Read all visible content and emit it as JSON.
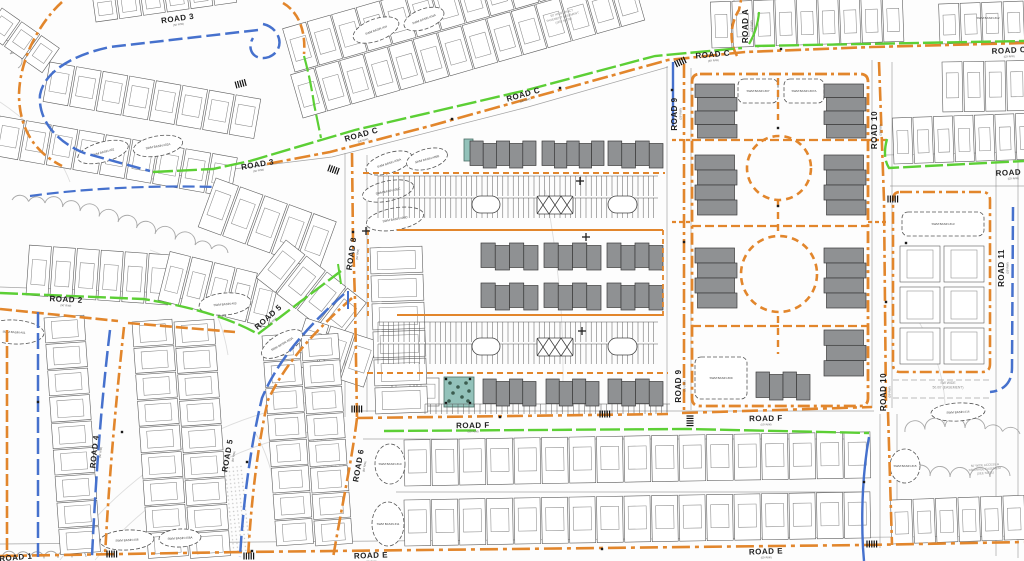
{
  "colors": {
    "bg": "#fdfdfd",
    "line": "#5e5e5e",
    "line_light": "#9a9a9a",
    "contour": "#c2c2c2",
    "orange": "#e2862c",
    "blue": "#4671cd",
    "green": "#5ccf35",
    "building": "#8f9193",
    "building_stroke": "#3a3a3a",
    "park": "#93c2ba",
    "tree": "#2c4a3c",
    "label": "#1f1f1f",
    "swm_label": "#444444",
    "note": "#8a8a8a",
    "tick": "#111111"
  },
  "canvas": {
    "w": 1024,
    "h": 561
  },
  "rw_sub": "(50' R/W)",
  "road_labels": [
    {
      "t": "ROAD 3",
      "x": 178,
      "y": 21,
      "r": -8
    },
    {
      "t": "ROAD 3",
      "x": 258,
      "y": 167,
      "r": -10
    },
    {
      "t": "ROAD C",
      "x": 362,
      "y": 137,
      "r": -16
    },
    {
      "t": "ROAD C",
      "x": 524,
      "y": 97,
      "r": -16
    },
    {
      "t": "ROAD C",
      "x": 713,
      "y": 57,
      "r": -5
    },
    {
      "t": "ROAD C",
      "x": 1009,
      "y": 53,
      "r": -3
    },
    {
      "t": "ROAD A",
      "x": 748,
      "y": 26,
      "r": -90
    },
    {
      "t": "ROAD 9",
      "x": 677,
      "y": 114,
      "r": -90
    },
    {
      "t": "ROAD 9",
      "x": 681,
      "y": 386,
      "r": -90
    },
    {
      "t": "ROAD 10",
      "x": 877,
      "y": 130,
      "r": -90
    },
    {
      "t": "ROAD 10",
      "x": 886,
      "y": 392,
      "r": -90
    },
    {
      "t": "ROAD 11",
      "x": 1004,
      "y": 268,
      "r": -90
    },
    {
      "t": "ROAD 8",
      "x": 354,
      "y": 254,
      "r": -82
    },
    {
      "t": "ROAD 6",
      "x": 361,
      "y": 466,
      "r": -80
    },
    {
      "t": "ROAD 4",
      "x": 97,
      "y": 452,
      "r": -84
    },
    {
      "t": "ROAD 5",
      "x": 230,
      "y": 456,
      "r": -80
    },
    {
      "t": "ROAD 5",
      "x": 270,
      "y": 319,
      "r": -42
    },
    {
      "t": "ROAD 2",
      "x": 66,
      "y": 302,
      "r": 3
    },
    {
      "t": "ROAD D",
      "x": 1013,
      "y": 175,
      "r": -3
    },
    {
      "t": "ROAD E",
      "x": 371,
      "y": 558,
      "r": -2
    },
    {
      "t": "ROAD E",
      "x": 766,
      "y": 554,
      "r": -2
    },
    {
      "t": "ROAD F",
      "x": 473,
      "y": 428,
      "r": -1
    },
    {
      "t": "ROAD F",
      "x": 766,
      "y": 421,
      "r": -1
    },
    {
      "t": "ROAD 1",
      "x": 16,
      "y": 560,
      "r": -5
    }
  ],
  "basins": [
    [
      103,
      152,
      26,
      10,
      -15,
      "e",
      "SWM BASIN #02"
    ],
    [
      158,
      146,
      25,
      10,
      -10,
      "e",
      "SWM BASIN #02A"
    ],
    [
      376,
      30,
      24,
      11,
      -20,
      "e",
      "SWM BASIN #04"
    ],
    [
      424,
      19,
      21,
      10,
      -20,
      "e",
      "SWM BASIN #04A"
    ],
    [
      389,
      163,
      24,
      10,
      -18,
      "e",
      "SWM BASIN #05A"
    ],
    [
      427,
      159,
      21,
      10,
      -15,
      "e",
      "SWM BASIN #05B"
    ],
    [
      388,
      191,
      26,
      10,
      -12,
      "e",
      "SWM BASIN #05C"
    ],
    [
      395,
      219,
      29,
      11,
      -10,
      "e",
      "SWM BASIN #05D"
    ],
    [
      14,
      332,
      30,
      12,
      3,
      "e",
      "SWM BASIN #01"
    ],
    [
      225,
      304,
      26,
      11,
      -5,
      "e",
      "SWM BASIN #03"
    ],
    [
      282,
      344,
      23,
      10,
      -30,
      "e",
      "SWM BASIN #03A"
    ],
    [
      127,
      540,
      27,
      10,
      -3,
      "e",
      "SWM BASIN #06"
    ],
    [
      180,
      538,
      21,
      9,
      -3,
      "e",
      "SWM BASIN #06A"
    ],
    [
      390,
      464,
      15,
      20,
      0,
      "e",
      "SWM BASIN #10"
    ],
    [
      388,
      524,
      16,
      22,
      0,
      "e",
      "SWM BASIN #11"
    ],
    [
      758,
      91,
      20,
      12,
      0,
      "r",
      "SWM BASIN #07"
    ],
    [
      804,
      91,
      20,
      12,
      0,
      "r",
      "SWM BASIN #07A"
    ],
    [
      721,
      378,
      26,
      21,
      0,
      "r",
      "SWM BASIN #09"
    ],
    [
      943,
      224,
      41,
      12,
      0,
      "r",
      "SWM BASIN #13"
    ],
    [
      958,
      412,
      27,
      9,
      -3,
      "e",
      "SWM BASIN #14"
    ],
    [
      905,
      466,
      15,
      17,
      0,
      "e",
      "SWM BASIN #15"
    ],
    [
      988,
      18,
      0,
      0,
      0,
      "l",
      "SWM BASIN #12"
    ]
  ],
  "notes": [
    {
      "x": 562,
      "y": 14,
      "r": -15,
      "s": 3,
      "lines": [
        "50' WIDE TRACT",
        "PAVEMENT EASEMENT",
        "(SEE NOTE)"
      ]
    },
    {
      "x": 948,
      "y": 384,
      "r": 0,
      "s": 3.4,
      "lines": [
        "SW WIDE",
        "50.00' (EASEMENT)"
      ]
    },
    {
      "x": 985,
      "y": 466,
      "r": -4,
      "s": 3,
      "lines": [
        "50' WIDE ACCESS &",
        "DRAINAGE EASEMENT",
        "(SEE NOTE)"
      ]
    }
  ],
  "utilities": {
    "orange": [
      {
        "d": "M62,2 C40,22 20,58 19,94 C19,128 34,152 62,166",
        "dash": "12 4 3 4"
      },
      {
        "d": "M267,164 L330,152 L430,126 L527,99 L668,60 L745,52 L872,47 L1024,43",
        "dash": "16 4 4 4"
      },
      {
        "d": "M737,56 C729,42 730,24 739,10 L741,0",
        "dash": "10 4"
      },
      {
        "d": "M283,3 C299,12 306,32 304,54",
        "dash": "10 4"
      },
      {
        "d": "M352,153 L353,240 L355,300 L357,418",
        "dash": "14 4 3 4"
      },
      {
        "d": "M357,418 C352,460 341,510 333,558",
        "dash": "14 4 3 4"
      },
      {
        "d": "M357,418 L668,414",
        "dash": "16 5 4 5"
      },
      {
        "d": "M682,413 L872,407",
        "dash": "16 5 4 5"
      },
      {
        "d": "M684,64 L684,413",
        "dash": "14 4 3 4"
      },
      {
        "d": "M879,62 L884,200 L886,410",
        "dash": "14 4 3 4"
      },
      {
        "d": "M888,412 L892,545",
        "dash": "14 4 3 4"
      },
      {
        "d": "M0,556 L243,552 L512,549 L864,545 L1024,542",
        "dash": "18 5 4 5"
      },
      {
        "d": "M7,330 L7,556",
        "dash": "12 4"
      },
      {
        "d": "M0,309 L118,321 M128,323 L235,332",
        "dash": "12 4"
      },
      {
        "d": "M124,327 C115,410 109,480 105,556",
        "dash": "12 4 3 4"
      },
      {
        "d": "M352,298 C314,332 286,362 268,400 C257,448 251,505 248,557",
        "dash": "12 4 3 4"
      },
      {
        "d": "M700,74 L860,74 Q868,74 868,82 L868,398 Q868,406 860,406 L700,406 Q692,406 692,398 L692,82 Q692,74 700,74",
        "dash": "12 4 3 4",
        "w": 2.8
      },
      {
        "d": "M778,78 L778,120 M778,200 L778,231 M778,316 L778,354",
        "dash": "7 5",
        "w": 2.4
      },
      {
        "d": "M692,140 L868,140 M692,226 L868,226 M692,326 L868,326",
        "dash": "9 4",
        "w": 2.2
      },
      {
        "d": "M672,140 L692,140 M868,140 L886,140 M672,222 L692,222 M868,222 L886,222",
        "dash": "4 3",
        "w": 2.2
      },
      {
        "d": "M900,192 L982,192 Q990,192 990,200 L990,364 Q990,372 982,372 L900,372 Q893,372 893,364 L893,200 Q893,192 900,192",
        "dash": "12 4 3 4",
        "w": 2.6
      },
      {
        "d": "M363,173 L665,173 M367,373 L668,373",
        "dash": "6 4",
        "w": 2
      },
      {
        "d": "M397,230 L663,230 M397,315 L663,315",
        "w": 2
      },
      {
        "d": "M368,230 L368,318 M663,230 L663,318",
        "dash": "5 4",
        "w": 1.8
      }
    ],
    "blue": [
      {
        "d": "M263,24 C281,28 286,50 269,57 C254,62 246,49 253,38",
        "dash": "14 5"
      },
      {
        "d": "M258,30 L110,47 C72,55 44,72 40,95 C38,119 55,141 84,153 L150,171",
        "dash": "14 5"
      },
      {
        "d": "M30,196 C80,189 150,185 215,187",
        "dash": "12 5",
        "w": 2.2
      },
      {
        "d": "M673,62 L673,126",
        "w": 2.4
      },
      {
        "d": "M348,291 L348,309",
        "w": 2
      },
      {
        "d": "M38,312 L38,557",
        "dash": "16 5"
      },
      {
        "d": "M110,330 C101,405 96,475 92,556",
        "dash": "16 5"
      },
      {
        "d": "M344,294 C306,328 278,360 262,398 C250,448 243,505 240,557",
        "dash": "16 5"
      },
      {
        "d": "M869,437 C863,470 861,510 863,548 L864,561",
        "w": 2.4
      },
      {
        "d": "M1013,207 L1012,368 C1012,384 1002,391 990,392",
        "dash": "14 5"
      }
    ],
    "green": [
      {
        "d": "M153,172 L213,169 L250,161 L355,130 L527,90 L655,56 L742,48",
        "dash": "20 4"
      },
      {
        "d": "M755,46 L1024,41",
        "dash": "20 4"
      },
      {
        "d": "M749,44 C755,34 758,24 759,12",
        "w": 2.2
      },
      {
        "d": "M304,56 C309,74 312,90 314,104 L321,138",
        "dash": "16 4",
        "w": 2.2
      },
      {
        "d": "M0,293 L143,299 C200,308 235,321 258,334 L300,302 L341,271",
        "dash": "18 4"
      },
      {
        "d": "M338,264 L341,284",
        "w": 2
      },
      {
        "d": "M384,431 L687,429 L869,433",
        "dash": "20 4"
      },
      {
        "d": "M887,139 C884,150 884,160 889,168 L1024,161",
        "dash": "18 4"
      }
    ]
  },
  "edges": [
    {
      "d": "M152,179 L332,157 L528,107 L668,67"
    },
    {
      "d": "M345,153 L345,417 M367,155 L367,412"
    },
    {
      "d": "M667,66 L667,412 M691,68 L691,410"
    },
    {
      "d": "M872,60 L872,408 M892,62 L892,408 M880,414 L880,548 M897,414 L897,545"
    },
    {
      "d": "M996,160 L996,556 M1018,152 L1018,558"
    },
    {
      "d": "M357,411 L874,411 M363,439 L870,439"
    },
    {
      "d": "M734,0 L734,52 M758,0 L758,48"
    },
    {
      "d": "M890,186 L1024,186 M886,155 L1024,152"
    },
    {
      "d": "M0,544 L1024,536"
    },
    {
      "d": "M0,287 L145,292 C205,300 240,315 262,328"
    },
    {
      "d": "M396,492 L868,492"
    },
    {
      "d": "M893,380 L990,380 M893,398 L990,398",
      "dash": "6 3"
    }
  ],
  "contours": [
    "M60,560 C120,480 200,420 320,400",
    "M95,560 C155,490 235,440 335,428",
    "M150,250 C195,265 220,305 228,355",
    "M545,190 C558,255 566,330 562,412",
    "M905,300 C930,335 950,382 944,425",
    "M0,102 C30,122 58,150 70,182",
    "M255,432 C272,462 281,500 276,540"
  ],
  "scallops": [
    {
      "pts": [
        [
          12,
          200
        ],
        [
          45,
          203
        ],
        [
          80,
          211
        ],
        [
          118,
          222
        ],
        [
          155,
          234
        ],
        [
          195,
          245
        ],
        [
          228,
          253
        ]
      ],
      "r": 9
    },
    {
      "pts": [
        [
          905,
          432
        ],
        [
          945,
          427
        ],
        [
          985,
          429
        ],
        [
          1020,
          434
        ]
      ],
      "r": 10
    },
    {
      "pts": [
        [
          893,
          470
        ],
        [
          930,
          476
        ],
        [
          970,
          478
        ],
        [
          1010,
          476
        ]
      ],
      "r": 9
    },
    {
      "pts": [
        [
          2,
          558
        ],
        [
          30,
          559
        ],
        [
          58,
          558
        ],
        [
          86,
          557
        ]
      ],
      "r": 7
    },
    {
      "pts": [
        [
          0,
          42
        ],
        [
          10,
          54
        ],
        [
          18,
          68
        ]
      ],
      "r": 7
    }
  ],
  "stipples": [
    [
      300,
      390,
      40,
      90,
      -5
    ],
    [
      217,
      468,
      26,
      86,
      -6
    ]
  ],
  "lot_strips": [
    {
      "x": 50,
      "y": 62,
      "a": 10,
      "n": 8,
      "w": 25,
      "g": 2,
      "d": 40
    },
    {
      "x": 0,
      "y": 116,
      "a": 10,
      "n": 9,
      "w": 25,
      "g": 2,
      "d": 40
    },
    {
      "x": 96,
      "y": 22,
      "a": -8,
      "n": 6,
      "w": 22,
      "g": 2,
      "d": -26
    },
    {
      "x": 303,
      "y": 118,
      "a": -16,
      "n": 14,
      "w": 24,
      "g": 1.5,
      "d": -45
    },
    {
      "x": 295,
      "y": 72,
      "a": -16,
      "n": 14,
      "w": 24,
      "g": 1.5,
      "d": -45
    },
    {
      "x": 712,
      "y": 48,
      "a": -2,
      "n": 9,
      "w": 20,
      "g": 1.5,
      "d": -46
    },
    {
      "x": 940,
      "y": 44,
      "a": -2,
      "n": 4,
      "w": 20,
      "g": 1.5,
      "d": -40
    },
    {
      "x": 942,
      "y": 62,
      "a": -1,
      "n": 4,
      "w": 20,
      "g": 1.5,
      "d": 50
    },
    {
      "x": 894,
      "y": 164,
      "a": -2,
      "n": 7,
      "w": 19,
      "g": 1.5,
      "d": -46
    },
    {
      "x": 404,
      "y": 440,
      "a": -1,
      "n": 17,
      "w": 26,
      "g": 1.5,
      "d": 46
    },
    {
      "x": 404,
      "y": 500,
      "a": -1,
      "n": 17,
      "w": 26,
      "g": 1.5,
      "d": 46
    },
    {
      "x": 892,
      "y": 544,
      "a": -2,
      "n": 6,
      "w": 21,
      "g": 1.5,
      "d": -44
    },
    {
      "x": 26,
      "y": 295,
      "a": 4,
      "n": 6,
      "w": 22,
      "g": 2,
      "d": -50
    },
    {
      "x": 158,
      "y": 300,
      "a": 14,
      "n": 5,
      "w": 21,
      "g": 2,
      "d": -50
    },
    {
      "x": 216,
      "y": 178,
      "a": 20,
      "n": 5,
      "w": 24,
      "g": 2,
      "d": 52
    },
    {
      "x": 286,
      "y": 240,
      "a": 38,
      "n": 4,
      "w": 24,
      "g": 2,
      "d": 48
    },
    {
      "x": 306,
      "y": 318,
      "a": 18,
      "n": 3,
      "w": 24,
      "g": 2,
      "d": 48
    },
    {
      "x": 392,
      "y": 378,
      "a": 0,
      "n": 2,
      "w": 22,
      "g": 3,
      "d": 28
    },
    {
      "x": 2,
      "y": 8,
      "a": 35,
      "n": 3,
      "w": 22,
      "g": 2,
      "d": 30
    }
  ],
  "vert_strips": [
    {
      "x": 370,
      "y": 248,
      "a": -2,
      "n": 6,
      "w": 52,
      "h": 26,
      "g": 2
    },
    {
      "x": 44,
      "y": 318,
      "a": -4,
      "n": 9,
      "w": 40,
      "h": 25,
      "g": 1.5
    },
    {
      "x": 132,
      "y": 322,
      "a": -4,
      "n": 9,
      "w": 40,
      "h": 25,
      "g": 1.5
    },
    {
      "x": 174,
      "y": 322,
      "a": -4,
      "n": 9,
      "w": 40,
      "h": 25,
      "g": 1.5
    },
    {
      "x": 262,
      "y": 336,
      "a": -4,
      "n": 8,
      "w": 37,
      "h": 25,
      "g": 1.5
    },
    {
      "x": 301,
      "y": 336,
      "a": -4,
      "n": 8,
      "w": 37,
      "h": 25,
      "g": 1.5
    },
    {
      "x": 900,
      "y": 246,
      "a": 0,
      "n": 3,
      "w": 40,
      "h": 36,
      "g": 5
    },
    {
      "x": 944,
      "y": 246,
      "a": 0,
      "n": 3,
      "w": 40,
      "h": 36,
      "g": 5
    }
  ],
  "buildings": [
    [
      470,
      141,
      66,
      27,
      5
    ],
    [
      542,
      141,
      62,
      27,
      5
    ],
    [
      608,
      141,
      55,
      27,
      4
    ],
    [
      481,
      243,
      57,
      27,
      4
    ],
    [
      544,
      243,
      57,
      27,
      4
    ],
    [
      607,
      243,
      56,
      27,
      4
    ],
    [
      481,
      283,
      57,
      27,
      4
    ],
    [
      544,
      283,
      57,
      27,
      4
    ],
    [
      607,
      283,
      56,
      27,
      4
    ],
    [
      483,
      379,
      53,
      27,
      4
    ],
    [
      546,
      379,
      53,
      27,
      4
    ],
    [
      608,
      379,
      55,
      27,
      4
    ],
    [
      695,
      84,
      42,
      54,
      4,
      1
    ],
    [
      824,
      84,
      42,
      54,
      4,
      1
    ],
    [
      695,
      155,
      42,
      60,
      4,
      1
    ],
    [
      824,
      155,
      42,
      60,
      4,
      1
    ],
    [
      695,
      248,
      42,
      60,
      4,
      1
    ],
    [
      824,
      248,
      42,
      60,
      4,
      1
    ],
    [
      824,
      330,
      42,
      46,
      3,
      1
    ],
    [
      756,
      372,
      54,
      28,
      4
    ]
  ],
  "parking_combs": [
    [
      378,
      176,
      280,
      20,
      5.2
    ],
    [
      378,
      198,
      280,
      20,
      5.2
    ],
    [
      378,
      322,
      280,
      20,
      5.2
    ],
    [
      378,
      344,
      280,
      20,
      5.2
    ],
    [
      425,
      404,
      245,
      10,
      5.5
    ]
  ],
  "islands": [
    [
      472,
      196,
      28,
      17,
      "bean"
    ],
    [
      537,
      196,
      36,
      18,
      "hatch"
    ],
    [
      608,
      196,
      29,
      17,
      "bean"
    ],
    [
      472,
      338,
      28,
      17,
      "bean"
    ],
    [
      537,
      338,
      36,
      18,
      "hatch"
    ],
    [
      608,
      338,
      29,
      17,
      "bean"
    ]
  ],
  "circles": [
    [
      779,
      168,
      32
    ],
    [
      779,
      274,
      38
    ]
  ],
  "parks": [
    {
      "x": 444,
      "y": 377,
      "w": 30,
      "h": 30,
      "trees": [
        [
          6,
          6
        ],
        [
          14,
          10
        ],
        [
          22,
          6
        ],
        [
          9,
          16
        ],
        [
          18,
          20
        ],
        [
          25,
          14
        ],
        [
          5,
          24
        ],
        [
          24,
          24
        ]
      ],
      "dots": [
        [
          2,
          2
        ],
        [
          26,
          2
        ],
        [
          2,
          26
        ],
        [
          26,
          26
        ]
      ]
    },
    {
      "x": 464,
      "y": 139,
      "w": 9,
      "h": 22,
      "trees": [],
      "dots": []
    }
  ],
  "ticks": [
    [
      236,
      85,
      -15
    ],
    [
      329,
      168,
      20
    ],
    [
      352,
      409,
      0
    ],
    [
      600,
      414,
      0
    ],
    [
      676,
      64,
      -25
    ],
    [
      888,
      199,
      0
    ],
    [
      867,
      544,
      0
    ],
    [
      690,
      416,
      90
    ],
    [
      244,
      556,
      0
    ],
    [
      107,
      554,
      0
    ]
  ],
  "crosses": [
    [
      580,
      181
    ],
    [
      586,
      237
    ],
    [
      582,
      331
    ],
    [
      366,
      231
    ]
  ],
  "dots": [
    [
      452,
      119
    ],
    [
      560,
      88
    ],
    [
      353,
      232
    ],
    [
      684,
      242
    ],
    [
      500,
      417
    ],
    [
      781,
      49
    ],
    [
      886,
      302
    ],
    [
      252,
      551
    ],
    [
      602,
      549
    ],
    [
      38,
      402
    ],
    [
      122,
      432
    ],
    [
      247,
      462
    ],
    [
      864,
      482
    ],
    [
      672,
      90
    ],
    [
      778,
      128
    ],
    [
      778,
      206
    ],
    [
      906,
      243
    ]
  ]
}
